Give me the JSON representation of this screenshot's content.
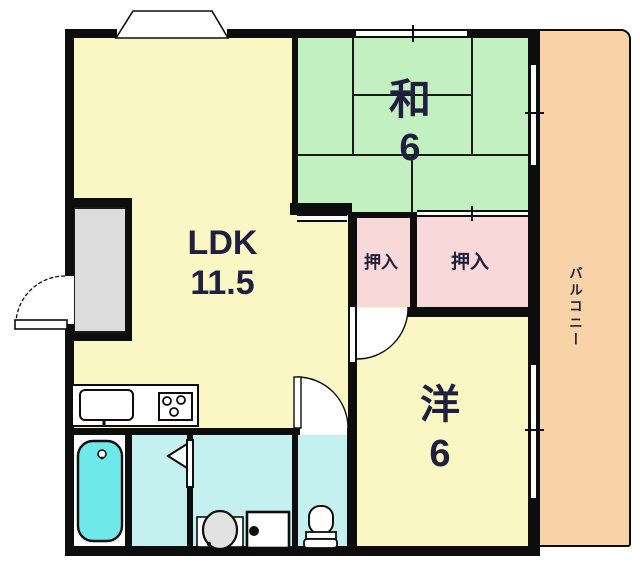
{
  "rooms": {
    "ldk": {
      "label": "LDK",
      "size": "11.5"
    },
    "washitsu": {
      "label": "和",
      "size": "6"
    },
    "youshitsu": {
      "label": "洋",
      "size": "6"
    },
    "oshiire_left": {
      "label": "押入"
    },
    "oshiire_right": {
      "label": "押入"
    },
    "balcony": {
      "label": "バルコニー"
    }
  },
  "colors": {
    "room_yellow": "#FAF7C5",
    "tatami_green": "#C3F0C0",
    "closet_pink": "#F8D8D8",
    "balcony_peach": "#F7D3A7",
    "wet_area_cyan": "#C5F0F0",
    "bathtub_cyan": "#6EE8E8",
    "entrance_gray": "#DCDCDC",
    "wall_black": "#0D0D0D",
    "label_navy": "#20203E"
  }
}
